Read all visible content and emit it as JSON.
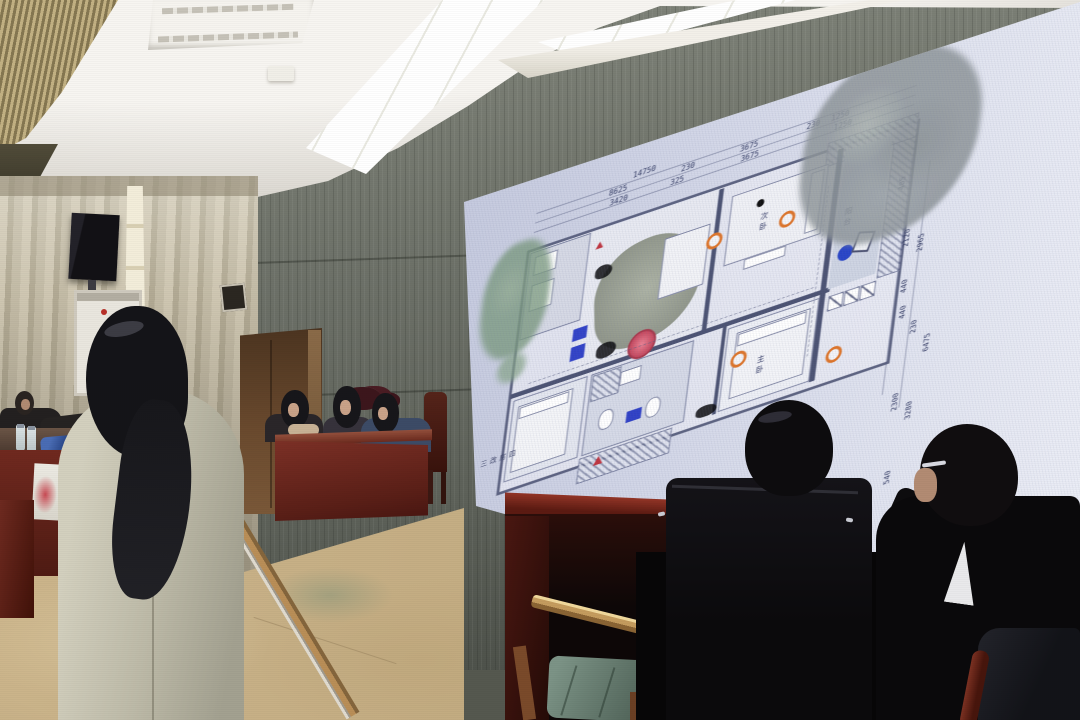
{
  "screen": {
    "plan_title_vertical": "四房改三",
    "room_labels": {
      "second_bedroom": "次卧",
      "master_bedroom": "主卧",
      "balcony": "阳台"
    },
    "dims": {
      "total_width": "14750",
      "seg_8625": "8625",
      "seg_3420": "3420",
      "seg_230a": "230",
      "seg_325": "325",
      "seg_3675a": "3675",
      "seg_3675b": "3675",
      "seg_230b": "230",
      "seg_1250a": "1250",
      "seg_1250b": "1250",
      "r_405": "405",
      "r_2120": "2120",
      "r_2965": "2965",
      "r_440a": "440",
      "r_440b": "440",
      "r_230": "230",
      "r_6475": "6475",
      "r_2300": "2300",
      "r_3280": "3280",
      "r_540": "540"
    }
  }
}
